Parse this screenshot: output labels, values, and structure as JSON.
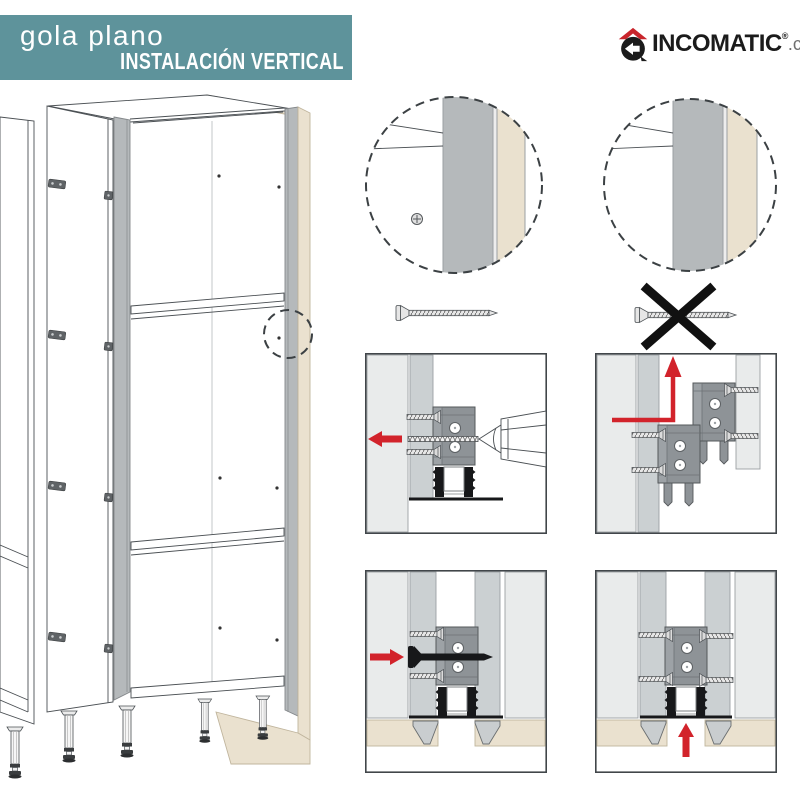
{
  "header": {
    "title": "gola plano",
    "subtitle": "INSTALACIÓN VERTICAL",
    "background": "#5E939B",
    "text_color": "#FFFFFF"
  },
  "logo": {
    "brand": "INCOMATIC",
    "registered_mark": "®",
    "domain": ".com",
    "roof_color": "#C9252C",
    "brand_color": "#1B1B1B",
    "domain_color": "#6E6E6E"
  },
  "palette": {
    "line": "#4B5054",
    "panel_border": "#41464A",
    "light_slab": "#E9EBEB",
    "mid_gray_panel": "#CBD0D2",
    "gola_profile_gray": "#B5B9BB",
    "bracket_gray": "#8E9397",
    "beige_panel": "#EAE1CF",
    "profile_black": "#17181A",
    "arrow_red": "#D2232B"
  },
  "icons": {
    "logo": "incomatic-house-logo-icon",
    "detail_left": "detail-circle-screw-icon",
    "detail_right": "detail-circle-no-screw-icon",
    "screw_allowed": "screw-icon",
    "screw_forbidden": "crossed-out-screw-icon",
    "cross": "x-mark-icon",
    "drill": "drill-icon",
    "arrows": [
      "arrow-left-icon",
      "arrow-corner-up-icon",
      "arrow-right-icon",
      "arrow-up-icon"
    ],
    "illustration": "tall-cabinet-gola-illustration"
  }
}
